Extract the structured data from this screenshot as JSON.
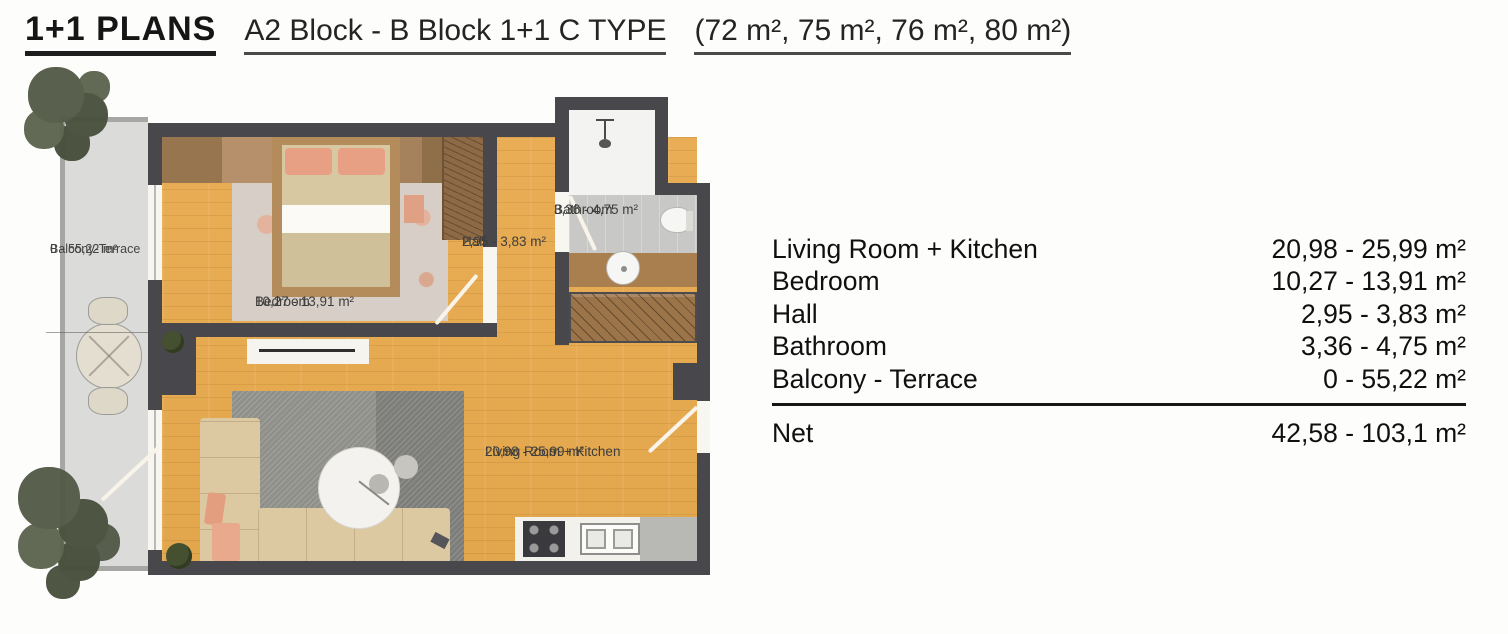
{
  "header": {
    "title": "1+1 PLANS",
    "subtitle_block": "A2 Block - B Block 1+1 C TYPE",
    "subtitle_sizes": "(72 m², 75 m², 76 m², 80 m²)"
  },
  "plan": {
    "balcony": {
      "name": "Balcony-Terrace",
      "area": "0 - 55,22 m²"
    },
    "bedroom": {
      "name": "Bedroom",
      "area": "10,27 - 13,91 m²"
    },
    "hall": {
      "name": "Hall",
      "area": "2,95 - 3,83 m²"
    },
    "bathroom": {
      "name": "Bathroom",
      "area": "3,36 - 4,75 m²"
    },
    "living": {
      "name": "Living Room + Kitchen",
      "area": "20,98 - 25,99 m²"
    }
  },
  "table": {
    "rows": [
      {
        "label": "Living Room + Kitchen",
        "value": "20,98 - 25,99 m²"
      },
      {
        "label": "Bedroom",
        "value": "10,27 - 13,91 m²"
      },
      {
        "label": "Hall",
        "value": "2,95 - 3,83 m²"
      },
      {
        "label": "Bathroom",
        "value": "3,36 - 4,75 m²"
      },
      {
        "label": "Balcony -  Terrace",
        "value": "0 - 55,22 m²"
      }
    ],
    "net": {
      "label": "Net",
      "value": "42,58 - 103,1  m²"
    }
  },
  "colors": {
    "wall": "#48484c",
    "wood": "#e6aa52",
    "balcony_floor": "#dbdbd9",
    "tile": "#c8c8c6"
  }
}
